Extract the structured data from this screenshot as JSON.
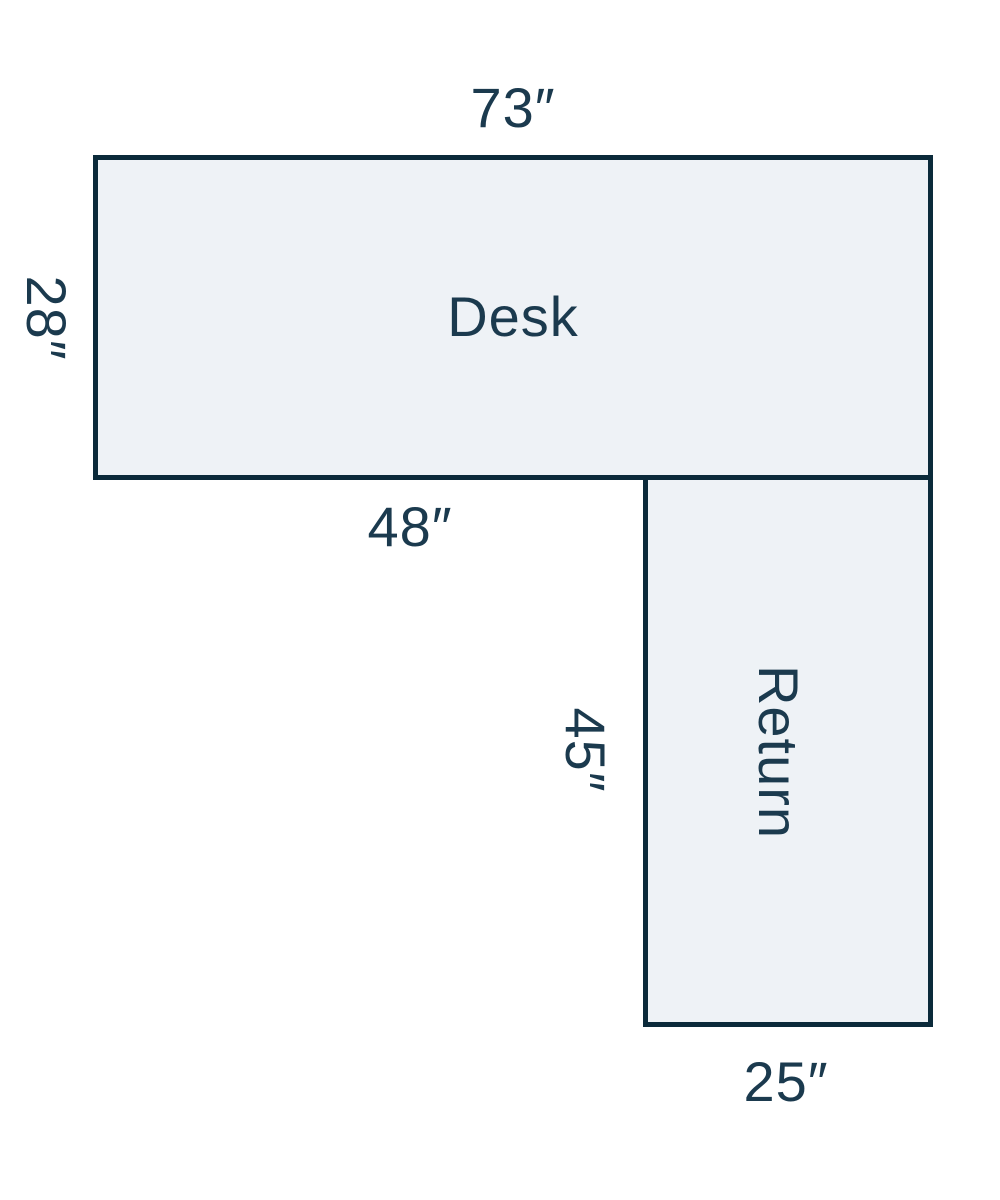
{
  "diagram": {
    "background_color": "#ffffff",
    "shape_fill_color": "#eef2f6",
    "shape_stroke_color": "#0b2a3a",
    "text_color": "#1b3a4e",
    "desk": {
      "label": "Desk",
      "top_dimension": "73″",
      "left_dimension": "28″",
      "bottom_dimension": "48″"
    },
    "return": {
      "label": "Return",
      "left_dimension": "45″",
      "bottom_dimension": "25″"
    }
  }
}
